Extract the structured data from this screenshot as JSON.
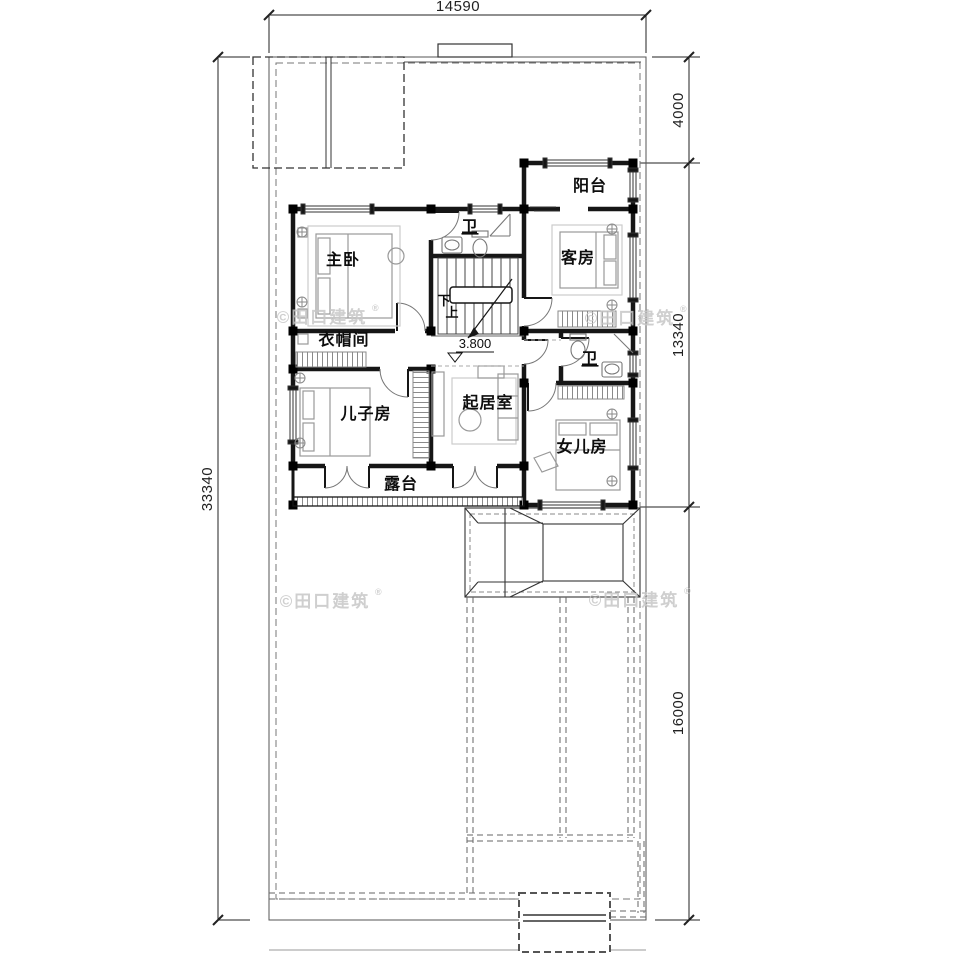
{
  "dimensions": {
    "top_width": "14590",
    "left_total": "33340",
    "right_top": "4000",
    "right_middle": "13340",
    "right_bottom": "16000"
  },
  "labels": {
    "balcony": "阳台",
    "bath_upper": "卫",
    "master_bedroom": "主卧",
    "guest_room": "客房",
    "cloakroom": "衣帽间",
    "son_room": "儿子房",
    "living_room": "起居室",
    "daughter_room": "女儿房",
    "bath_lower": "卫",
    "terrace": "露台",
    "stair_down": "下",
    "stair_up": "上",
    "elevation": "3.800"
  },
  "watermark": {
    "text": "©田口建筑",
    "reg": "®"
  },
  "colors": {
    "line": "#1a1a1a",
    "furniture": "#999999",
    "watermark": "#c7c7c7",
    "background": "#ffffff"
  }
}
